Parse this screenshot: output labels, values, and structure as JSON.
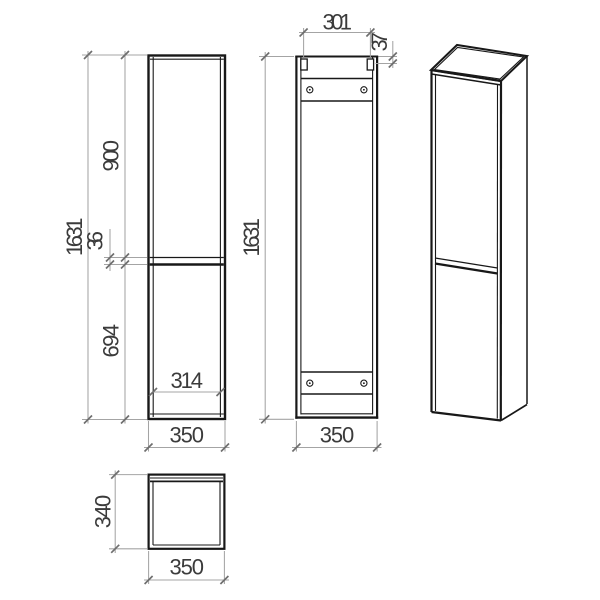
{
  "drawing": {
    "title": "tall cabinet technical drawing",
    "front_view": {
      "total_height": "1631",
      "upper_door_height": "900",
      "door_gap": "36",
      "lower_door_height": "694",
      "inner_width": "314",
      "overall_width": "350"
    },
    "back_view": {
      "hanger_span": "301",
      "hanger_offset": "37",
      "total_height": "1631",
      "overall_width": "350"
    },
    "top_view": {
      "depth": "340",
      "overall_width": "350"
    },
    "colors": {
      "object_line": "#181818",
      "dimension_line": "#a4a4a4",
      "text": "#3b3b3b",
      "background": "#ffffff"
    }
  }
}
